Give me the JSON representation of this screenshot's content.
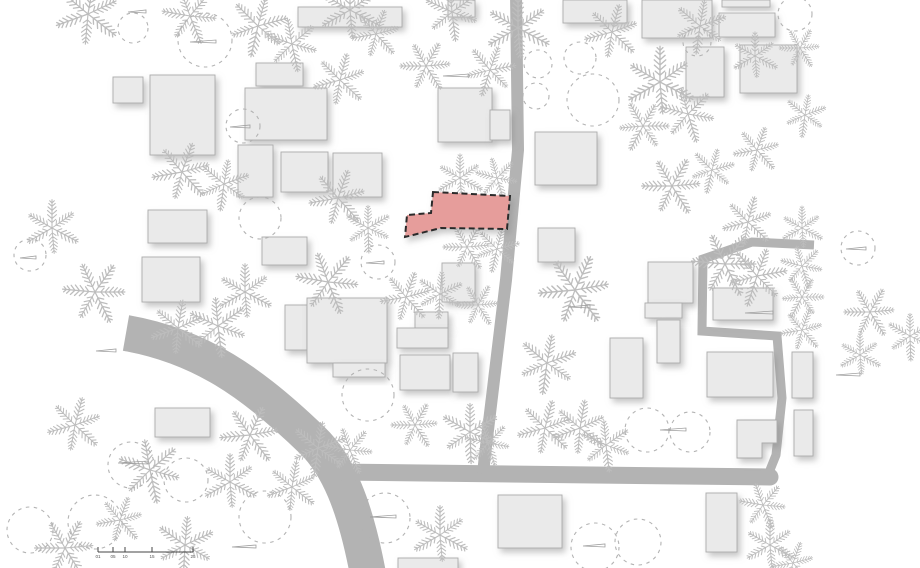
{
  "canvas": {
    "width": 920,
    "height": 568,
    "background": "#ffffff"
  },
  "colors": {
    "road": "#b3b3b3",
    "building_fill": "#eaeaea",
    "building_stroke": "#ababab",
    "palm_stroke": "#bdbdbd",
    "bush_stroke": "#b3b3b3",
    "flag_stroke": "#9e9e9e",
    "site_fill": "#e69d9b",
    "site_stroke": "#2a2a2a",
    "scale_stroke": "#444444",
    "scale_text": "#555555",
    "shadow": "#8a8a8a"
  },
  "roads": [
    {
      "name": "curved-main-road",
      "d": "M126,333 C200,346 252,382 312,440 C338,465 355,505 368,574",
      "width": 36,
      "cap": "butt"
    },
    {
      "name": "horizontal-road",
      "d": "M333,472 L770,477",
      "width": 17,
      "cap": "round"
    },
    {
      "name": "vertical-road",
      "d": "M516,-6 L518,150 L506,280 L494,380 L485,455 L483,474",
      "width": 12,
      "cap": "butt"
    },
    {
      "name": "narrow-lane",
      "d": "M814,245 L752,242 L703,259 L702,331 L777,336 L782,398 L776,455 L770,470",
      "width": 9,
      "cap": "butt"
    }
  ],
  "buildings": [
    [
      298,
      7,
      104,
      20
    ],
    [
      113,
      77,
      30,
      26
    ],
    [
      150,
      75,
      65,
      80
    ],
    [
      256,
      63,
      47,
      23
    ],
    [
      245,
      88,
      82,
      52
    ],
    [
      238,
      145,
      35,
      52
    ],
    [
      281,
      152,
      47,
      40
    ],
    [
      333,
      153,
      49,
      44
    ],
    [
      148,
      210,
      59,
      33
    ],
    [
      262,
      237,
      45,
      28
    ],
    [
      448,
      0,
      27,
      17
    ],
    [
      438,
      88,
      54,
      54
    ],
    [
      490,
      110,
      20,
      30
    ],
    [
      535,
      132,
      62,
      53
    ],
    [
      563,
      0,
      64,
      23
    ],
    [
      642,
      0,
      70,
      38
    ],
    [
      722,
      0,
      48,
      7
    ],
    [
      719,
      13,
      56,
      24
    ],
    [
      686,
      47,
      38,
      50
    ],
    [
      740,
      45,
      57,
      48
    ],
    [
      538,
      228,
      37,
      34
    ],
    [
      442,
      263,
      33,
      39
    ],
    [
      142,
      257,
      58,
      45
    ],
    [
      285,
      305,
      22,
      45
    ],
    [
      307,
      298,
      80,
      65
    ],
    [
      333,
      363,
      52,
      14
    ],
    [
      415,
      312,
      33,
      16
    ],
    [
      397,
      328,
      51,
      20
    ],
    [
      400,
      355,
      50,
      35
    ],
    [
      453,
      353,
      25,
      39
    ],
    [
      648,
      262,
      45,
      41
    ],
    [
      645,
      303,
      37,
      15
    ],
    [
      657,
      320,
      23,
      43
    ],
    [
      610,
      338,
      33,
      60
    ],
    [
      713,
      288,
      60,
      32
    ],
    [
      707,
      352,
      66,
      45
    ],
    [
      792,
      352,
      21,
      46
    ],
    [
      794,
      410,
      19,
      46
    ],
    {
      "pts": [
        [
          737,
          420
        ],
        [
          777,
          420
        ],
        [
          777,
          443
        ],
        [
          762,
          443
        ],
        [
          762,
          458
        ],
        [
          737,
          458
        ]
      ]
    },
    [
      398,
      558,
      60,
      12
    ],
    [
      498,
      495,
      64,
      53
    ],
    [
      706,
      493,
      31,
      59
    ],
    [
      155,
      408,
      55,
      29
    ]
  ],
  "site_building": {
    "label": "highlighted-site-building",
    "pts": [
      [
        433,
        192
      ],
      [
        510,
        196
      ],
      [
        507,
        229
      ],
      [
        441,
        228
      ],
      [
        405,
        237
      ],
      [
        407,
        215
      ],
      [
        431,
        213
      ]
    ],
    "dash": "6 3.5",
    "stroke_width": 2
  },
  "trees": {
    "palms": [
      [
        88,
        14,
        1.6,
        10
      ],
      [
        190,
        16,
        1.35,
        40
      ],
      [
        258,
        26,
        1.45,
        75
      ],
      [
        350,
        10,
        1.5,
        0
      ],
      [
        376,
        34,
        1.2,
        20
      ],
      [
        452,
        12,
        1.35,
        55
      ],
      [
        518,
        28,
        1.6,
        0
      ],
      [
        426,
        66,
        1.25,
        30
      ],
      [
        490,
        70,
        1.25,
        80
      ],
      [
        340,
        80,
        1.3,
        15
      ],
      [
        292,
        44,
        1.3,
        50
      ],
      [
        612,
        32,
        1.35,
        15
      ],
      [
        700,
        26,
        1.3,
        70
      ],
      [
        755,
        56,
        1.15,
        0
      ],
      [
        800,
        48,
        1.0,
        30
      ],
      [
        660,
        82,
        1.7,
        0
      ],
      [
        688,
        114,
        1.35,
        45
      ],
      [
        643,
        126,
        1.25,
        90
      ],
      [
        712,
        170,
        1.1,
        75
      ],
      [
        757,
        150,
        1.15,
        20
      ],
      [
        672,
        186,
        1.45,
        30
      ],
      [
        805,
        115,
        1.05,
        70
      ],
      [
        182,
        172,
        1.45,
        20
      ],
      [
        224,
        184,
        1.25,
        70
      ],
      [
        460,
        178,
        1.15,
        0
      ],
      [
        497,
        178,
        1.05,
        45
      ],
      [
        338,
        198,
        1.4,
        20
      ],
      [
        368,
        228,
        1.15,
        60
      ],
      [
        467,
        247,
        1.15,
        30
      ],
      [
        497,
        249,
        1.1,
        75
      ],
      [
        52,
        228,
        1.35,
        0
      ],
      [
        95,
        292,
        1.55,
        35
      ],
      [
        178,
        328,
        1.35,
        10
      ],
      [
        218,
        326,
        1.45,
        55
      ],
      [
        245,
        292,
        1.35,
        0
      ],
      [
        328,
        282,
        1.55,
        40
      ],
      [
        406,
        297,
        1.25,
        20
      ],
      [
        440,
        294,
        1.15,
        65
      ],
      [
        478,
        305,
        1.05,
        30
      ],
      [
        575,
        290,
        1.75,
        25
      ],
      [
        547,
        363,
        1.45,
        70
      ],
      [
        580,
        428,
        1.35,
        10
      ],
      [
        606,
        445,
        1.25,
        55
      ],
      [
        725,
        264,
        1.6,
        35
      ],
      [
        757,
        276,
        1.45,
        80
      ],
      [
        748,
        222,
        1.25,
        15
      ],
      [
        802,
        228,
        1.05,
        0
      ],
      [
        802,
        266,
        1.05,
        45
      ],
      [
        802,
        297,
        1.05,
        90
      ],
      [
        802,
        330,
        1.05,
        20
      ],
      [
        870,
        312,
        1.25,
        30
      ],
      [
        910,
        336,
        1.15,
        60
      ],
      [
        860,
        355,
        1.05,
        0
      ],
      [
        250,
        435,
        1.45,
        25
      ],
      [
        318,
        448,
        1.35,
        70
      ],
      [
        292,
        487,
        1.25,
        10
      ],
      [
        350,
        450,
        1.15,
        40
      ],
      [
        75,
        425,
        1.35,
        15
      ],
      [
        150,
        470,
        1.55,
        50
      ],
      [
        230,
        482,
        1.35,
        0
      ],
      [
        65,
        548,
        1.45,
        30
      ],
      [
        185,
        545,
        1.45,
        65
      ],
      [
        120,
        520,
        1.15,
        20
      ],
      [
        415,
        425,
        1.15,
        30
      ],
      [
        470,
        432,
        1.45,
        60
      ],
      [
        545,
        428,
        1.35,
        15
      ],
      [
        488,
        443,
        1.1,
        45
      ],
      [
        440,
        535,
        1.4,
        0
      ],
      [
        763,
        505,
        1.15,
        40
      ],
      [
        770,
        545,
        1.25,
        0
      ],
      [
        793,
        563,
        1.05,
        20
      ]
    ],
    "bush_circles": [
      [
        205,
        40,
        27
      ],
      [
        133,
        28,
        15
      ],
      [
        243,
        126,
        17
      ],
      [
        260,
        218,
        21
      ],
      [
        378,
        262,
        17
      ],
      [
        536,
        96,
        13
      ],
      [
        538,
        64,
        14
      ],
      [
        580,
        58,
        16
      ],
      [
        593,
        100,
        26
      ],
      [
        697,
        42,
        14
      ],
      [
        795,
        14,
        17
      ],
      [
        858,
        248,
        17
      ],
      [
        131,
        465,
        23
      ],
      [
        186,
        480,
        22
      ],
      [
        30,
        530,
        23
      ],
      [
        95,
        522,
        27
      ],
      [
        265,
        517,
        26
      ],
      [
        385,
        518,
        25
      ],
      [
        595,
        547,
        24
      ],
      [
        638,
        542,
        23
      ],
      [
        647,
        430,
        22
      ],
      [
        690,
        432,
        20
      ],
      [
        30,
        255,
        16
      ],
      [
        368,
        395,
        26
      ]
    ],
    "flags": [
      [
        190,
        42,
        26
      ],
      [
        118,
        463,
        30
      ],
      [
        370,
        517,
        26
      ],
      [
        583,
        546,
        22
      ],
      [
        660,
        430,
        26
      ],
      [
        745,
        313,
        28
      ],
      [
        836,
        375,
        24
      ],
      [
        568,
        307,
        22
      ],
      [
        443,
        76,
        26
      ],
      [
        128,
        12,
        18
      ],
      [
        232,
        547,
        24
      ],
      [
        366,
        263,
        18
      ],
      [
        846,
        249,
        20
      ],
      [
        96,
        351,
        20
      ],
      [
        20,
        258,
        16
      ],
      [
        230,
        127,
        20
      ]
    ]
  },
  "scale_bar": {
    "y": 552,
    "x_start": 98,
    "x_end": 193,
    "tick_height": 5,
    "ticks": [
      {
        "x": 98,
        "label": "01"
      },
      {
        "x": 113,
        "label": "05"
      },
      {
        "x": 125,
        "label": "10"
      },
      {
        "x": 152,
        "label": "15"
      },
      {
        "x": 193,
        "label": "25"
      }
    ]
  }
}
